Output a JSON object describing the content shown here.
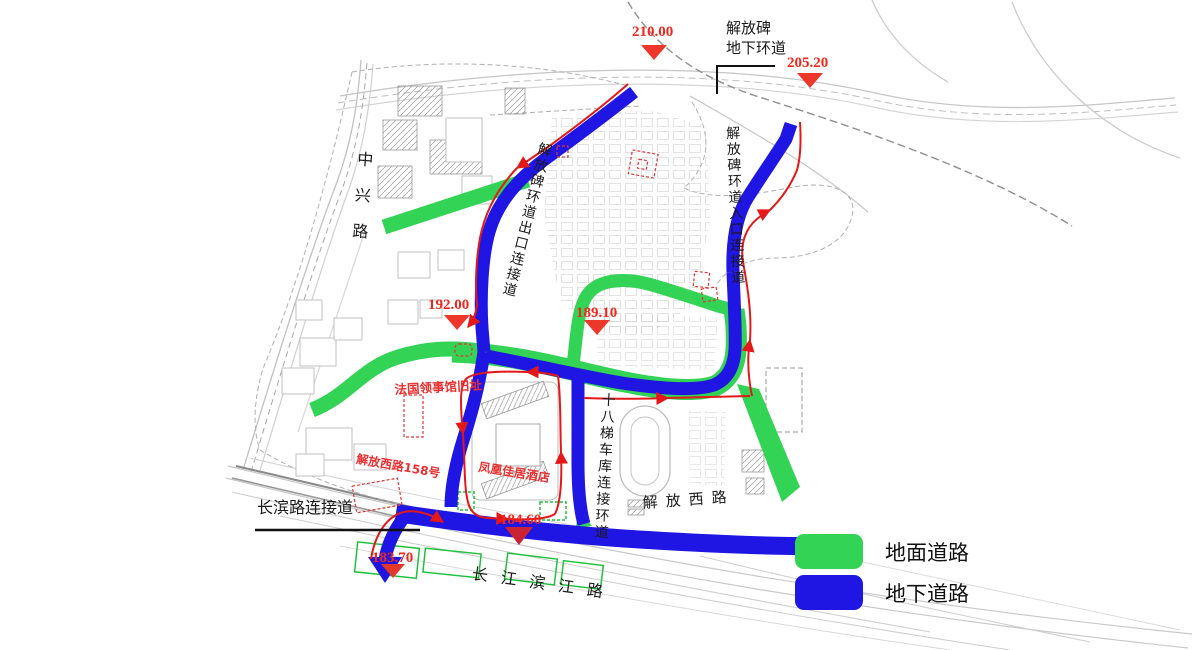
{
  "labels": {
    "jiefangbei_line1": "解放碑",
    "jiefangbei_line2": "地下环道",
    "zhongxing": "中兴路",
    "exit_connector": "解放碑环道出口连接道",
    "entrance_connector": "解放碑环道入口连接道",
    "garage_loop": "十八梯车库连接环道",
    "jiefang_west": "解放西路",
    "changbin_connector": "长滨路连接道",
    "binjiang": "长江滨江路",
    "french_consulate": "法国领事馆旧址",
    "jiefangxi_158": "解放西路158号",
    "phoenix_hotel": "凤凰佳居酒店"
  },
  "elevations": {
    "e210": "210.00",
    "e205": "205.20",
    "e192": "192.00",
    "e189": "189.10",
    "e184": "184.60",
    "e183": "183.70"
  },
  "legend": {
    "ground": "地面道路",
    "underground": "地下道路"
  },
  "colors": {
    "ground_road": "#33d455",
    "underground_road": "#1f16e3",
    "elevation_marker_red": "#ee372b",
    "route_arrow_red": "#e41818"
  }
}
